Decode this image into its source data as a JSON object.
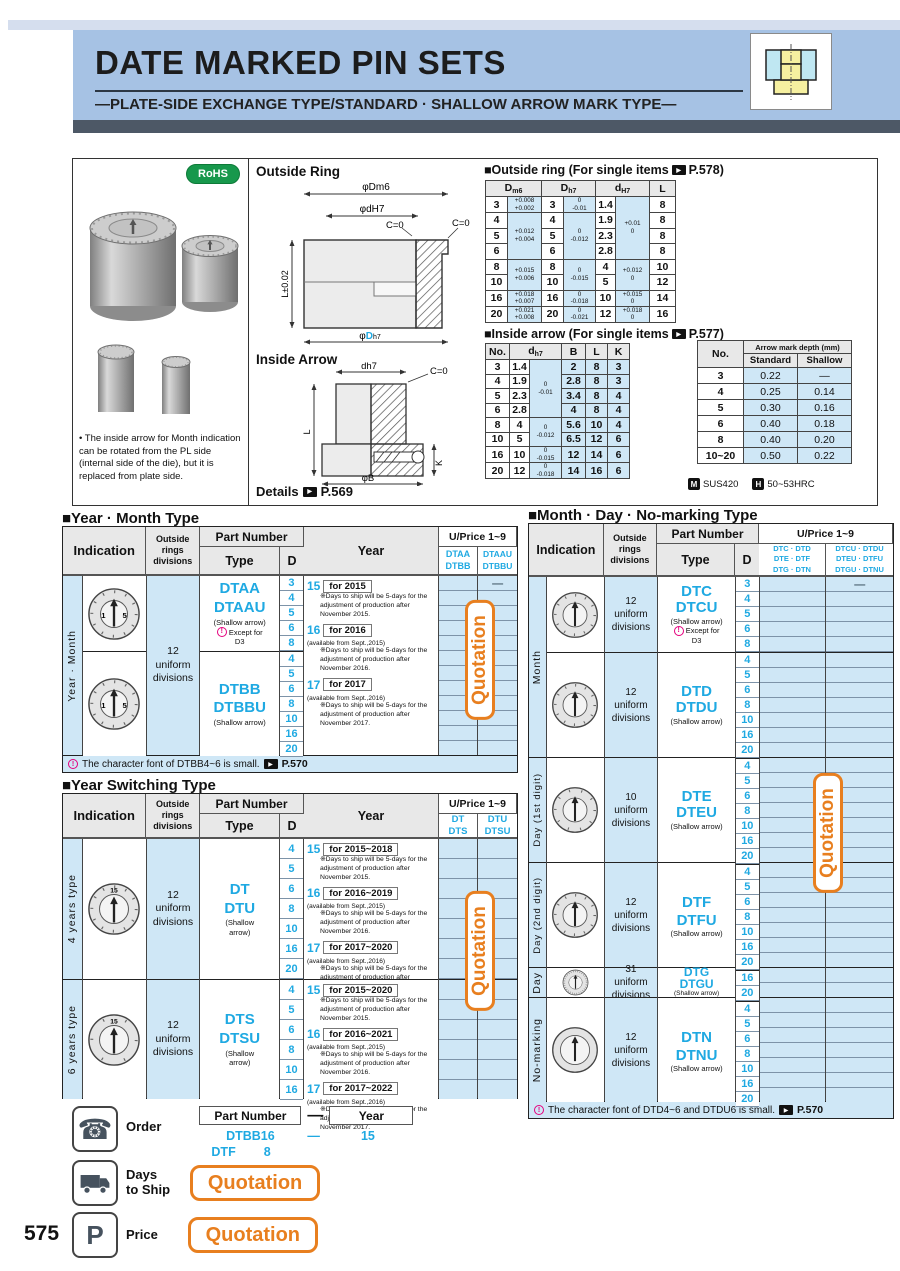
{
  "page_number": "575",
  "header": {
    "title": "DATE MARKED PIN SETS",
    "subtitle": "—PLATE-SIDE EXCHANGE TYPE/STANDARD · SHALLOW ARROW MARK TYPE—"
  },
  "rohs": "RoHS",
  "photo_note": "• The inside arrow for Month indication can be rotated from the PL side (internal side of the die), but it is replaced from plate side.",
  "diagram": {
    "outside_ring": "Outside Ring",
    "inside_arrow": "Inside Arrow",
    "details": "Details",
    "details_page": "P.569",
    "dm6": "φDm6",
    "dh7s": "φdH7",
    "c0a": "C=0",
    "c0b": "C=0",
    "ltol": "L±0.02",
    "phi": "φ",
    "bigD": "D",
    "bigD_sub": "h7",
    "ia_dh7": "dh7",
    "ia_c0": "C=0",
    "ia_l": "L",
    "ia_k": "K",
    "ia_b": "φB"
  },
  "ort": {
    "t1": "■Outside ring (For single items",
    "t2": "P.578)",
    "hd": "D",
    "hds": "m6",
    "hh": "D",
    "hhs": "h7",
    "hs": "d",
    "hss": "H7",
    "hl": "L",
    "r0": {
      "d": "3",
      "dt1": "+0.008",
      "dt2": "+0.002",
      "h": "3",
      "ht1": "0",
      "ht2": "-0.01",
      "s": "1.4",
      "st1": "+0.01",
      "st2": "0",
      "l": "8"
    },
    "r1": {
      "d": "4",
      "dt1": "+0.012",
      "dt2": "+0.004",
      "h": "4",
      "ht1": "0",
      "ht2": "-0.012",
      "s": "1.9",
      "l": "8"
    },
    "r2": {
      "d": "5",
      "h": "5",
      "s": "2.3",
      "l": "8"
    },
    "r3": {
      "d": "6",
      "h": "6",
      "s": "2.8",
      "l": "8"
    },
    "r4": {
      "d": "8",
      "dt1": "+0.015",
      "dt2": "+0.006",
      "h": "8",
      "ht1": "0",
      "ht2": "-0.015",
      "s": "4",
      "st1": "+0.012",
      "st2": "0",
      "l": "10"
    },
    "r5": {
      "d": "10",
      "h": "10",
      "s": "5",
      "l": "12"
    },
    "r6": {
      "d": "16",
      "dt1": "+0.018",
      "dt2": "+0.007",
      "h": "16",
      "ht1": "0",
      "ht2": "-0.018",
      "s": "10",
      "st1": "+0.015",
      "st2": "0",
      "l": "14"
    },
    "r7": {
      "d": "20",
      "dt1": "+0.021",
      "dt2": "+0.008",
      "h": "20",
      "ht1": "0",
      "ht2": "-0.021",
      "s": "12",
      "st1": "+0.018",
      "st2": "0",
      "l": "16"
    }
  },
  "iat": {
    "t1": "■Inside arrow (For single items",
    "t2": "P.577)",
    "hno": "No.",
    "hd": "d",
    "hds": "h7",
    "hb": "B",
    "hl": "L",
    "hk": "K",
    "r0": {
      "no": "3",
      "d": "1.4",
      "t1": "0",
      "t2": "-0.01",
      "b": "2",
      "l": "8",
      "k": "3"
    },
    "r1": {
      "no": "4",
      "d": "1.9",
      "b": "2.8",
      "l": "8",
      "k": "3"
    },
    "r2": {
      "no": "5",
      "d": "2.3",
      "b": "3.4",
      "l": "8",
      "k": "4"
    },
    "r3": {
      "no": "6",
      "d": "2.8",
      "b": "4",
      "l": "8",
      "k": "4"
    },
    "r4": {
      "no": "8",
      "d": "4",
      "t1": "0",
      "t2": "-0.012",
      "b": "5.6",
      "l": "10",
      "k": "4"
    },
    "r5": {
      "no": "10",
      "d": "5",
      "b": "6.5",
      "l": "12",
      "k": "6"
    },
    "r6": {
      "no": "16",
      "d": "10",
      "t1": "0",
      "t2": "-0.015",
      "b": "12",
      "l": "14",
      "k": "6"
    },
    "r7": {
      "no": "20",
      "d": "12",
      "t1": "0",
      "t2": "-0.018",
      "b": "14",
      "l": "16",
      "k": "6"
    }
  },
  "amd": {
    "hno": "No.",
    "ht": "Arrow mark depth (mm)",
    "hstd": "Standard",
    "hsh": "Shallow",
    "rows": [
      {
        "no": "3",
        "std": "0.22",
        "sh": "—"
      },
      {
        "no": "4",
        "std": "0.25",
        "sh": "0.14"
      },
      {
        "no": "5",
        "std": "0.30",
        "sh": "0.16"
      },
      {
        "no": "6",
        "std": "0.40",
        "sh": "0.18"
      },
      {
        "no": "8",
        "std": "0.40",
        "sh": "0.20"
      },
      {
        "no": "10~20",
        "std": "0.50",
        "sh": "0.22"
      }
    ]
  },
  "material": {
    "m": "SUS420",
    "h": "50~53HRC"
  },
  "labels": {
    "indication": "Indication",
    "rings1": "Outside",
    "rings2": "rings",
    "rings3": "divisions",
    "part_number": "Part Number",
    "type": "Type",
    "d": "D",
    "year": "Year",
    "uprice": "U/Price 1~9",
    "quotation": "Quotation",
    "shallow": "(Shallow arrow)",
    "shallow1": "(Shallow",
    "shallow2": "arrow)",
    "except1": "Except for",
    "except2": "D3",
    "dash": "—",
    "order": "Order",
    "days1": "Days",
    "days2": "to Ship",
    "price": "Price",
    "ref570": "P.570"
  },
  "dials": {
    "n1": "1",
    "n2": "5",
    "top": "15"
  },
  "ym": {
    "title": "■Year · Month Type",
    "side": "Year · Month",
    "p1a": "DTAA",
    "p1b": "DTBB",
    "p2a": "DTAAU",
    "p2b": "DTBBU",
    "rings": {
      "a": "12",
      "b": "uniform",
      "c": "divisions"
    },
    "b1": {
      "t1": "DTAA",
      "t2": "DTAAU",
      "d": [
        "3",
        "4",
        "5",
        "6",
        "8"
      ]
    },
    "b2": {
      "t1": "DTBB",
      "t2": "DTBBU",
      "d": [
        "4",
        "5",
        "6",
        "8",
        "10",
        "16",
        "20"
      ]
    },
    "years": [
      {
        "n": "15",
        "box": "for 2015",
        "avail": "",
        "note": "※Days to ship will be 5-days for the adjustment of production after November 2015."
      },
      {
        "n": "16",
        "box": "for 2016",
        "avail": "(available from Sept.,2015)",
        "note": "※Days to ship will be 5-days for the adjustment of production after November 2016."
      },
      {
        "n": "17",
        "box": "for 2017",
        "avail": "(available from Sept.,2016)",
        "note": "※Days to ship will be 5-days for the adjustment of production after November 2017."
      }
    ],
    "footer": "The character font of DTBB4~6 is small."
  },
  "ys": {
    "title": "■Year Switching Type",
    "p1a": "DT",
    "p1b": "DTS",
    "p2a": "DTU",
    "p2b": "DTSU",
    "b1": {
      "side": "4 years type",
      "rings": {
        "a": "12",
        "b": "uniform",
        "c": "divisions"
      },
      "t1": "DT",
      "t2": "DTU",
      "d": [
        "4",
        "5",
        "6",
        "8",
        "10",
        "16",
        "20"
      ],
      "years": [
        {
          "n": "15",
          "box": "for 2015~2018",
          "avail": "",
          "note": "※Days to ship will be 5-days for the adjustment of production after November 2015."
        },
        {
          "n": "16",
          "box": "for 2016~2019",
          "avail": "(available from Sept.,2015)",
          "note": "※Days to ship will be 5-days for the adjustment of production after November 2016."
        },
        {
          "n": "17",
          "box": "for 2017~2020",
          "avail": "(available from Sept.,2016)",
          "note": "※Days to ship will be 5-days for the adjustment of production after November 2017."
        }
      ]
    },
    "b2": {
      "side": "6 years type",
      "rings": {
        "a": "12",
        "b": "uniform",
        "c": "divisions"
      },
      "t1": "DTS",
      "t2": "DTSU",
      "d": [
        "4",
        "5",
        "6",
        "8",
        "10",
        "16"
      ],
      "years": [
        {
          "n": "15",
          "box": "for 2015~2020",
          "avail": "",
          "note": "※Days to ship will be 5-days for the adjustment of production after November 2015."
        },
        {
          "n": "16",
          "box": "for 2016~2021",
          "avail": "(available from Sept.,2015)",
          "note": "※Days to ship will be 5-days for the adjustment of production after November 2016."
        },
        {
          "n": "17",
          "box": "for 2017~2022",
          "avail": "(available from Sept.,2016)",
          "note": "※Days to ship will be 5-days for the adjustment of production after November 2017."
        }
      ]
    }
  },
  "md": {
    "title": "■Month · Day · No-marking Type",
    "pc1": [
      "DTC · DTD",
      "DTE · DTF",
      "DTG · DTN"
    ],
    "pc2": [
      "DTCU · DTDU",
      "DTEU · DTFU",
      "DTGU · DTNU"
    ],
    "blocks": [
      {
        "side": "Month",
        "ringsa": "12",
        "ringsb": "uniform",
        "ringsc": "divisions",
        "t1": "DTC",
        "t2": "DTCU",
        "d": [
          "3",
          "4",
          "5",
          "6",
          "8"
        ]
      },
      {
        "ringsa": "12",
        "ringsb": "uniform",
        "ringsc": "divisions",
        "t1": "DTD",
        "t2": "DTDU",
        "d": [
          "4",
          "5",
          "6",
          "8",
          "10",
          "16",
          "20"
        ]
      },
      {
        "side": "Day (1st digit)",
        "ringsa": "10",
        "ringsb": "uniform",
        "ringsc": "divisions",
        "t1": "DTE",
        "t2": "DTEU",
        "d": [
          "4",
          "5",
          "6",
          "8",
          "10",
          "16",
          "20"
        ]
      },
      {
        "side": "Day (2nd digit)",
        "ringsa": "12",
        "ringsb": "uniform",
        "ringsc": "divisions",
        "t1": "DTF",
        "t2": "DTFU",
        "d": [
          "4",
          "5",
          "6",
          "8",
          "10",
          "16",
          "20"
        ]
      },
      {
        "side": "Day",
        "ringsa": "31",
        "ringsb": "uniform",
        "ringsc": "divisions",
        "t1": "DTG",
        "t2": "DTGU",
        "d": [
          "16",
          "20"
        ]
      },
      {
        "side": "No-marking",
        "ringsa": "12",
        "ringsb": "uniform",
        "ringsc": "divisions",
        "t1": "DTN",
        "t2": "DTNU",
        "d": [
          "4",
          "5",
          "6",
          "8",
          "10",
          "16",
          "20"
        ]
      }
    ],
    "footer": "The character font of DTD4~6 and DTDU6 is small."
  },
  "order": {
    "pn_box": "Part Number",
    "dash": "—",
    "year_box": "Year",
    "ex1_pn": "DTBB16",
    "ex1_dash": "—",
    "ex1_year": "15",
    "ex2_pn": "DTF",
    "ex2_d": "8"
  }
}
